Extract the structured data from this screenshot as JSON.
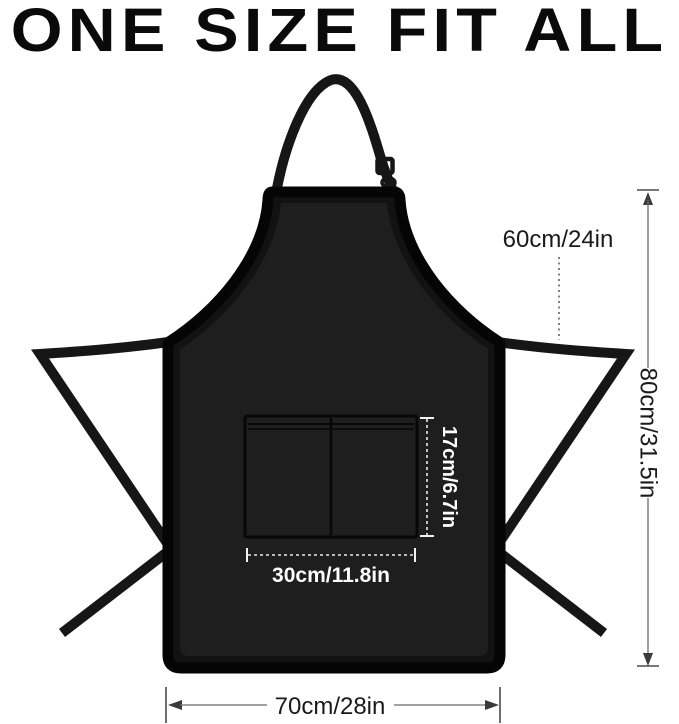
{
  "title": "ONE SIZE FIT ALL",
  "dimensions": {
    "neck_strap": "60cm/24in",
    "body_height": "80cm/31.5in",
    "pocket_height": "17cm/6.7in",
    "pocket_width": "30cm/11.8in",
    "body_width": "70cm/28in"
  },
  "colors": {
    "background": "#ffffff",
    "title_color": "#0a0a0a",
    "apron_body": "#121212",
    "apron_inner": "#1e1e1e",
    "apron_border": "#050505",
    "strap_color": "#161616",
    "dim_dark": "#1a1a1a",
    "dim_light": "#ffffff"
  }
}
